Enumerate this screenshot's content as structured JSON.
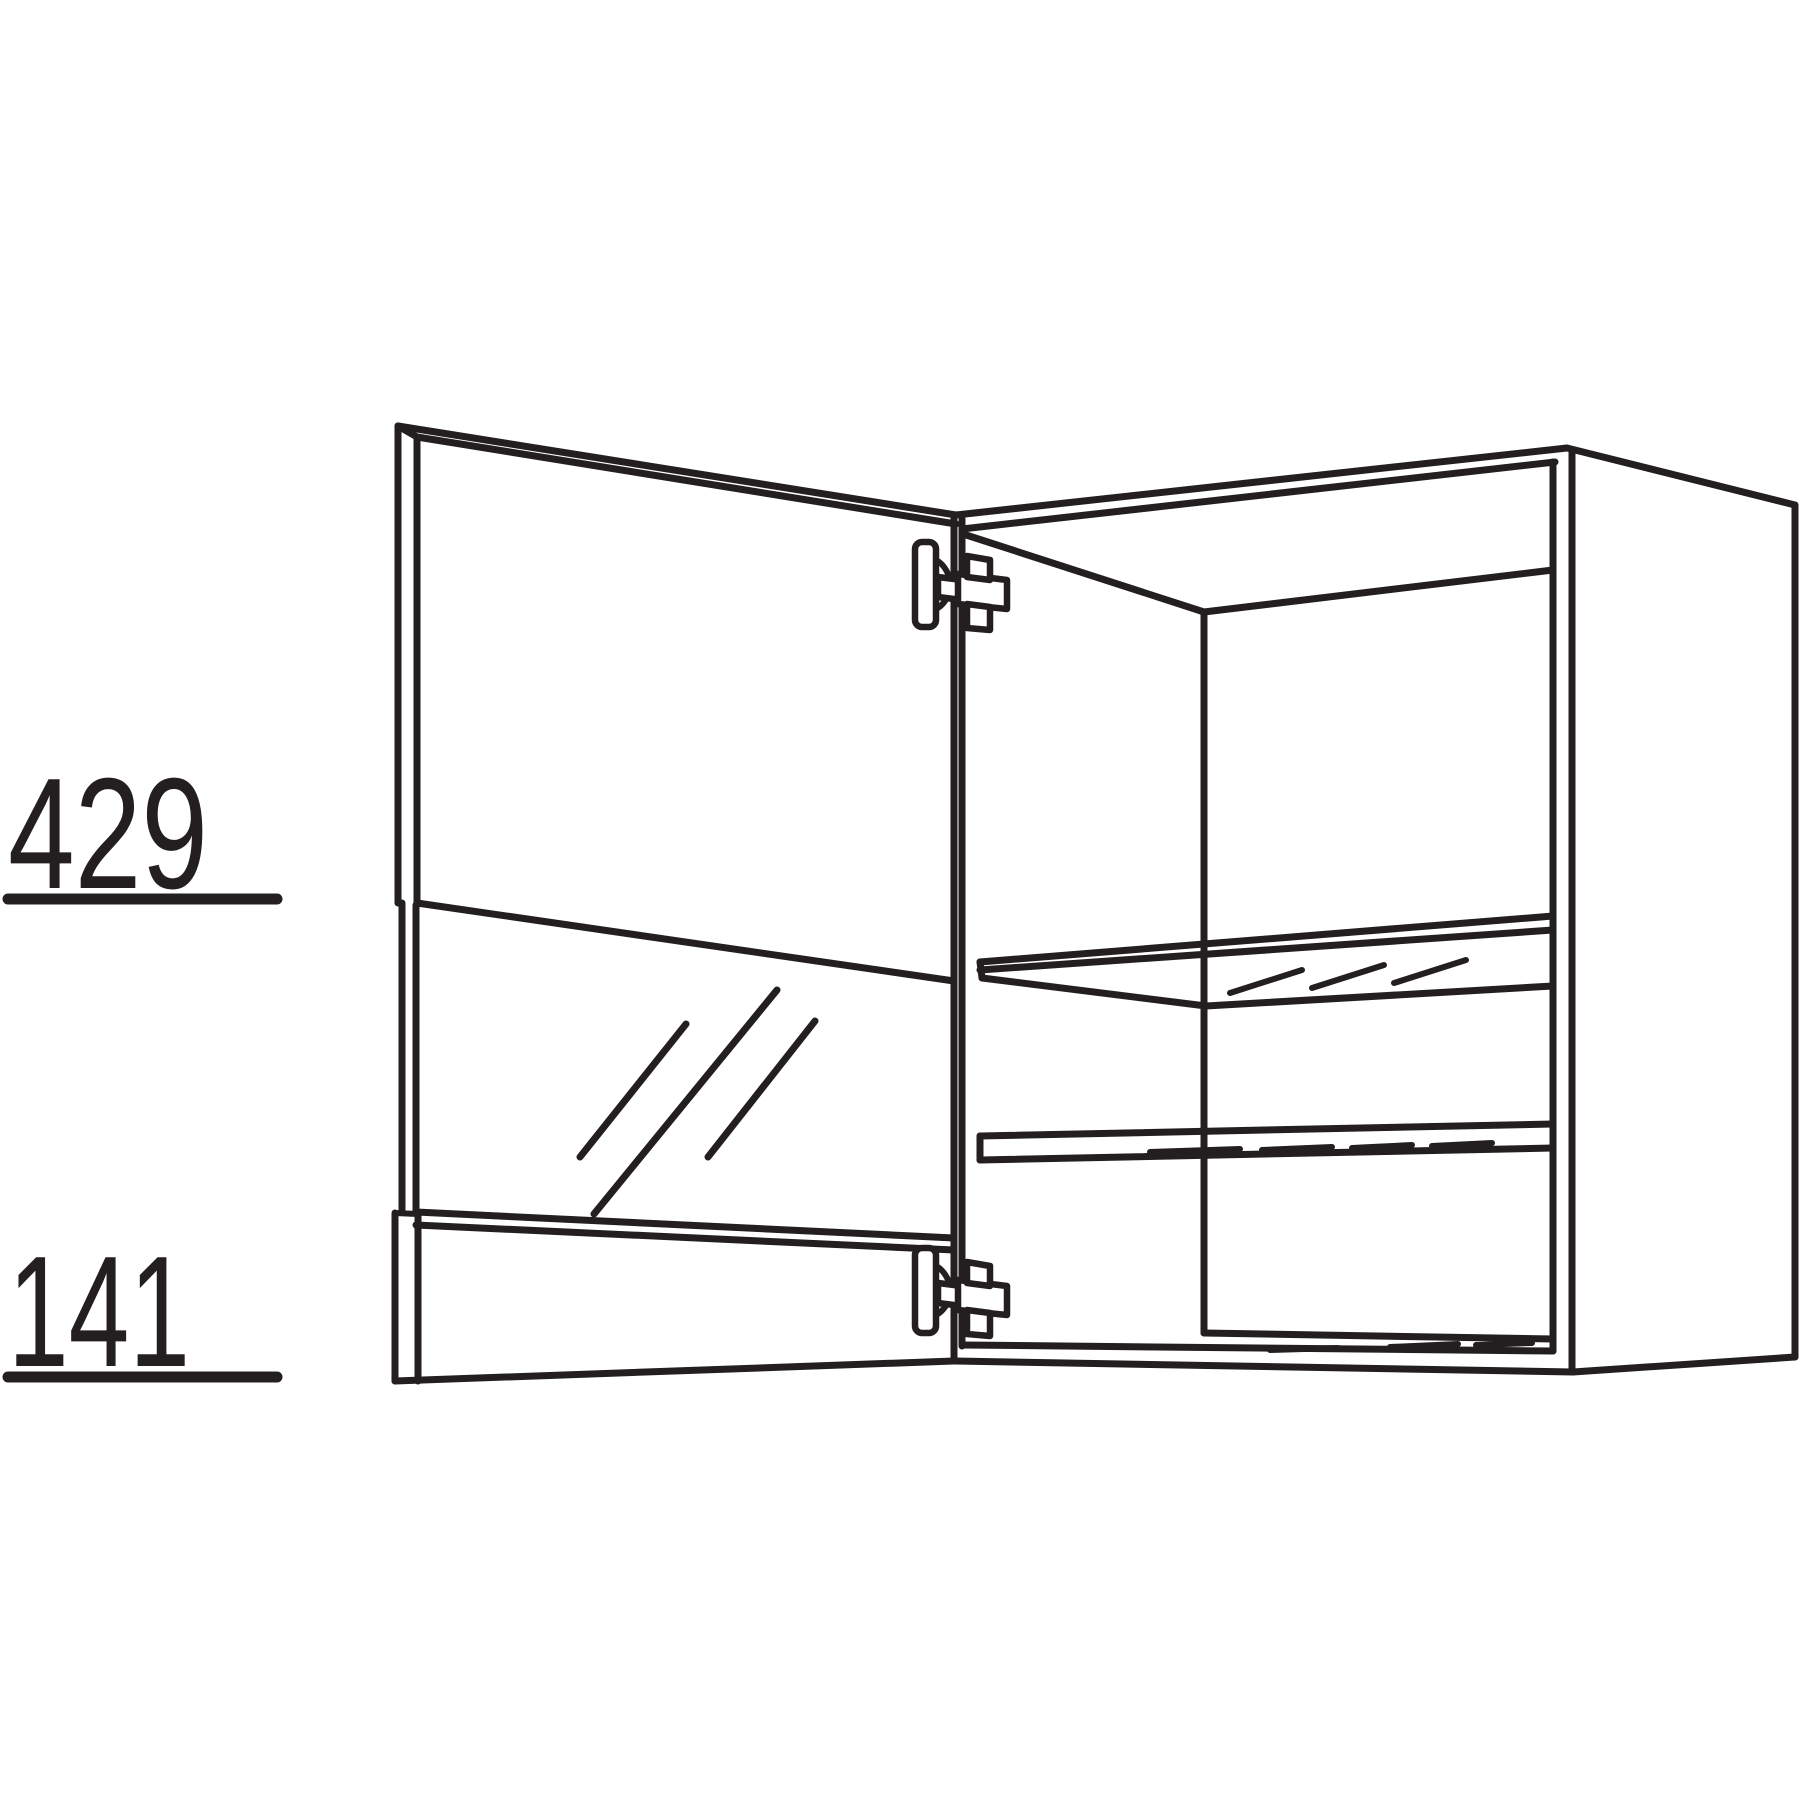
{
  "page": {
    "background": "#ffffff"
  },
  "drawing": {
    "type": "furniture-technical-line-drawing",
    "subject": "wall cabinet with open glass door, two glass shelves and two hinges",
    "line_color": "#231f20",
    "dimensions": {
      "upper": {
        "label": "429",
        "underlined": true
      },
      "lower": {
        "label": "141",
        "underlined": true
      }
    }
  }
}
